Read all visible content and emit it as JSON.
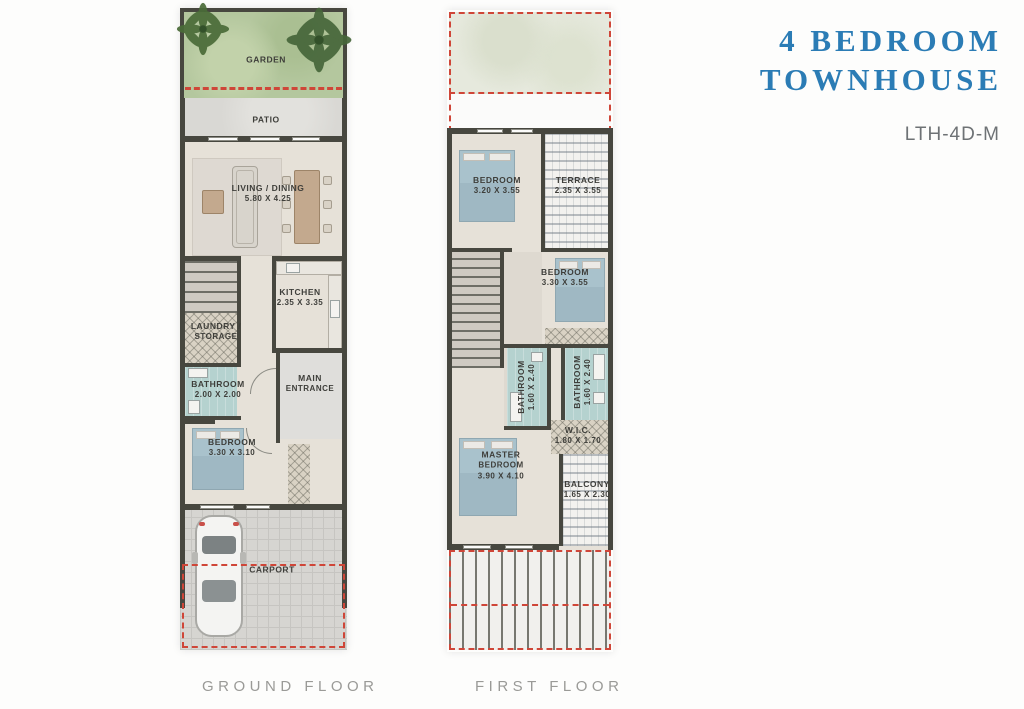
{
  "header": {
    "title_line1": "4 BEDROOM",
    "title_line2": "TOWNHOUSE",
    "unit_code": "LTH-4D-M"
  },
  "colors": {
    "title_blue": "#2b7cb5",
    "red_dashed": "#cf4638",
    "wall_gray": "#47473f",
    "garden_green": "#b4c79e",
    "bathroom_teal": "#b5d2cf"
  },
  "ground_floor": {
    "caption": "GROUND FLOOR",
    "rooms": [
      {
        "name": "GARDEN",
        "dims": ""
      },
      {
        "name": "PATIO",
        "dims": ""
      },
      {
        "name": "LIVING / DINING",
        "dims": "5.80 X 4.25"
      },
      {
        "name": "KITCHEN",
        "dims": "2.35 X 3.35"
      },
      {
        "name": "LAUNDRY /",
        "dims": "STORAGE"
      },
      {
        "name": "BATHROOM",
        "dims": "2.00 X 2.00"
      },
      {
        "name": "MAIN",
        "dims": "ENTRANCE"
      },
      {
        "name": "BEDROOM",
        "dims": "3.30 X 3.10"
      },
      {
        "name": "CARPORT",
        "dims": ""
      }
    ]
  },
  "first_floor": {
    "caption": "FIRST FLOOR",
    "rooms": [
      {
        "name": "BEDROOM",
        "dims": "3.20 X 3.55"
      },
      {
        "name": "TERRACE",
        "dims": "2.35 X 3.55"
      },
      {
        "name": "BEDROOM",
        "dims": "3.30 X 3.55"
      },
      {
        "name": "BATHROOM",
        "dims": "1.60 X 2.40"
      },
      {
        "name": "BATHROOM",
        "dims": "1.60 X 2.40"
      },
      {
        "name": "W.I.C.",
        "dims": "1.80 X 1.70"
      },
      {
        "name": "MASTER",
        "dims2": "BEDROOM",
        "dims": "3.90 X 4.10"
      },
      {
        "name": "BALCONY",
        "dims": "1.65 X 2.30"
      }
    ]
  }
}
